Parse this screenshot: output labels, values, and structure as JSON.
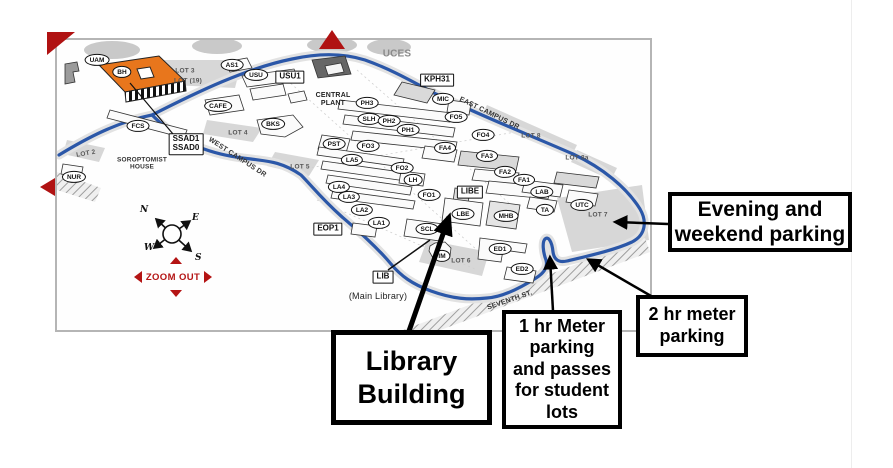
{
  "viewer": {
    "zoom_out_label": "ZOOM OUT",
    "compass": {
      "north": "N",
      "east": "E",
      "south": "S",
      "west": "W"
    },
    "accent_red": "#b41414",
    "route_blue": "#2b57a8"
  },
  "map": {
    "markers": [
      {
        "lines": [
          "UAM"
        ],
        "shape": "oval",
        "x": 40,
        "y": 20
      },
      {
        "lines": [
          "BH"
        ],
        "shape": "oval",
        "x": 65,
        "y": 32
      },
      {
        "lines": [
          "AS1"
        ],
        "shape": "oval",
        "x": 175,
        "y": 25
      },
      {
        "lines": [
          "USU"
        ],
        "shape": "oval",
        "x": 199,
        "y": 35
      },
      {
        "lines": [
          "USU1"
        ],
        "shape": "box",
        "x": 233,
        "y": 37
      },
      {
        "lines": [
          "CAFE"
        ],
        "shape": "oval",
        "x": 161,
        "y": 66
      },
      {
        "lines": [
          "BKS"
        ],
        "shape": "oval",
        "x": 216,
        "y": 84
      },
      {
        "lines": [
          "FCS"
        ],
        "shape": "oval",
        "x": 81,
        "y": 86
      },
      {
        "lines": [
          "NUR"
        ],
        "shape": "oval",
        "x": 17,
        "y": 137
      },
      {
        "lines": [
          "SSAD1",
          "SSAD0"
        ],
        "shape": "box",
        "x": 129,
        "y": 104
      },
      {
        "lines": [
          "KPH31"
        ],
        "shape": "box",
        "x": 380,
        "y": 40
      },
      {
        "lines": [
          "MIC"
        ],
        "shape": "oval",
        "x": 386,
        "y": 59
      },
      {
        "lines": [
          "PH3"
        ],
        "shape": "oval",
        "x": 310,
        "y": 63
      },
      {
        "lines": [
          "SLH"
        ],
        "shape": "oval",
        "x": 312,
        "y": 79
      },
      {
        "lines": [
          "PH2"
        ],
        "shape": "oval",
        "x": 332,
        "y": 81
      },
      {
        "lines": [
          "PH1"
        ],
        "shape": "oval",
        "x": 351,
        "y": 90
      },
      {
        "lines": [
          "FO5"
        ],
        "shape": "oval",
        "x": 399,
        "y": 77
      },
      {
        "lines": [
          "FO4"
        ],
        "shape": "oval",
        "x": 426,
        "y": 95
      },
      {
        "lines": [
          "FA4"
        ],
        "shape": "oval",
        "x": 388,
        "y": 108
      },
      {
        "lines": [
          "FA3"
        ],
        "shape": "oval",
        "x": 430,
        "y": 116
      },
      {
        "lines": [
          "FA2"
        ],
        "shape": "oval",
        "x": 448,
        "y": 132
      },
      {
        "lines": [
          "FA1"
        ],
        "shape": "oval",
        "x": 467,
        "y": 140
      },
      {
        "lines": [
          "PST"
        ],
        "shape": "oval",
        "x": 277,
        "y": 104
      },
      {
        "lines": [
          "FO3"
        ],
        "shape": "oval",
        "x": 311,
        "y": 106
      },
      {
        "lines": [
          "LA5"
        ],
        "shape": "oval",
        "x": 295,
        "y": 120
      },
      {
        "lines": [
          "FO2"
        ],
        "shape": "oval",
        "x": 345,
        "y": 128
      },
      {
        "lines": [
          "LH"
        ],
        "shape": "oval",
        "x": 356,
        "y": 140
      },
      {
        "lines": [
          "LA4"
        ],
        "shape": "oval",
        "x": 282,
        "y": 147
      },
      {
        "lines": [
          "LA3"
        ],
        "shape": "oval",
        "x": 292,
        "y": 157
      },
      {
        "lines": [
          "FO1"
        ],
        "shape": "oval",
        "x": 372,
        "y": 155
      },
      {
        "lines": [
          "LA2"
        ],
        "shape": "oval",
        "x": 305,
        "y": 170
      },
      {
        "lines": [
          "LA1"
        ],
        "shape": "oval",
        "x": 322,
        "y": 183
      },
      {
        "lines": [
          "SCL"
        ],
        "shape": "oval",
        "x": 370,
        "y": 189
      },
      {
        "lines": [
          "LIBE"
        ],
        "shape": "box",
        "x": 413,
        "y": 152
      },
      {
        "lines": [
          "LBE"
        ],
        "shape": "oval",
        "x": 406,
        "y": 174
      },
      {
        "lines": [
          "MHB"
        ],
        "shape": "oval",
        "x": 449,
        "y": 176
      },
      {
        "lines": [
          "LAB"
        ],
        "shape": "oval",
        "x": 485,
        "y": 152
      },
      {
        "lines": [
          "TA"
        ],
        "shape": "oval",
        "x": 488,
        "y": 170
      },
      {
        "lines": [
          "UTC"
        ],
        "shape": "oval",
        "x": 525,
        "y": 165
      },
      {
        "lines": [
          "IM"
        ],
        "shape": "oval",
        "x": 385,
        "y": 216
      },
      {
        "lines": [
          "ED1"
        ],
        "shape": "oval",
        "x": 443,
        "y": 209
      },
      {
        "lines": [
          "ED2"
        ],
        "shape": "oval",
        "x": 465,
        "y": 229
      },
      {
        "lines": [
          "EOP1"
        ],
        "shape": "box",
        "x": 271,
        "y": 189
      },
      {
        "lines": [
          "LIB"
        ],
        "shape": "box",
        "x": 326,
        "y": 237
      }
    ],
    "area_labels": [
      {
        "text": "UCES",
        "x": 340,
        "y": 14,
        "size": 10,
        "color": "#8a8a8a"
      },
      {
        "text": "CENTRAL\nPLANT",
        "x": 276,
        "y": 60,
        "size": 7,
        "color": "#222"
      },
      {
        "text": "SOROPTOMIST\nHOUSE",
        "x": 85,
        "y": 124,
        "size": 6.5,
        "color": "#333"
      },
      {
        "text": "(Main Library)",
        "x": 321,
        "y": 256,
        "size": 9,
        "color": "#222",
        "weight": "normal"
      },
      {
        "text": "LOT 2",
        "x": 29,
        "y": 114,
        "size": 6.5,
        "color": "#555",
        "rot": -10
      },
      {
        "text": "LOT 3",
        "x": 128,
        "y": 31,
        "size": 6.5,
        "color": "#555"
      },
      {
        "text": "LOT (19)",
        "x": 131,
        "y": 41,
        "size": 6.5,
        "color": "#555"
      },
      {
        "text": "LOT 4",
        "x": 181,
        "y": 93,
        "size": 6.5,
        "color": "#555"
      },
      {
        "text": "LOT 5",
        "x": 243,
        "y": 127,
        "size": 6.5,
        "color": "#555"
      },
      {
        "text": "LOT 6",
        "x": 404,
        "y": 221,
        "size": 6.5,
        "color": "#555"
      },
      {
        "text": "LOT 7",
        "x": 541,
        "y": 175,
        "size": 6.5,
        "color": "#555"
      },
      {
        "text": "LOT 8",
        "x": 474,
        "y": 96,
        "size": 6.5,
        "color": "#555"
      },
      {
        "text": "LOT 8a",
        "x": 520,
        "y": 118,
        "size": 6.5,
        "color": "#555"
      },
      {
        "text": "WEST CAMPUS DR",
        "x": 180,
        "y": 118,
        "size": 7,
        "color": "#333",
        "rot": 33
      },
      {
        "text": "EAST CAMPUS DR",
        "x": 432,
        "y": 74,
        "size": 7,
        "color": "#333",
        "rot": 26
      },
      {
        "text": "SEVENTH ST.",
        "x": 453,
        "y": 261,
        "size": 7,
        "color": "#333",
        "rot": -19
      }
    ]
  },
  "callouts": [
    {
      "id": "evening-weekend-parking",
      "lines": [
        "Evening and",
        "weekend parking"
      ],
      "x": 668,
      "y": 192,
      "w": 184,
      "h": 60,
      "font": 21,
      "border": 4
    },
    {
      "id": "two-hr-meter-parking",
      "lines": [
        "2 hr meter",
        "parking"
      ],
      "x": 636,
      "y": 295,
      "w": 112,
      "h": 62,
      "font": 18,
      "border": 4
    },
    {
      "id": "one-hr-meter-parking",
      "lines": [
        "1 hr Meter",
        "parking",
        "and passes",
        "for student",
        "lots"
      ],
      "x": 502,
      "y": 310,
      "w": 120,
      "h": 119,
      "font": 18,
      "border": 4
    },
    {
      "id": "library-building",
      "lines": [
        "Library",
        "Building"
      ],
      "x": 331,
      "y": 330,
      "w": 161,
      "h": 95,
      "font": 27,
      "border": 5
    }
  ]
}
